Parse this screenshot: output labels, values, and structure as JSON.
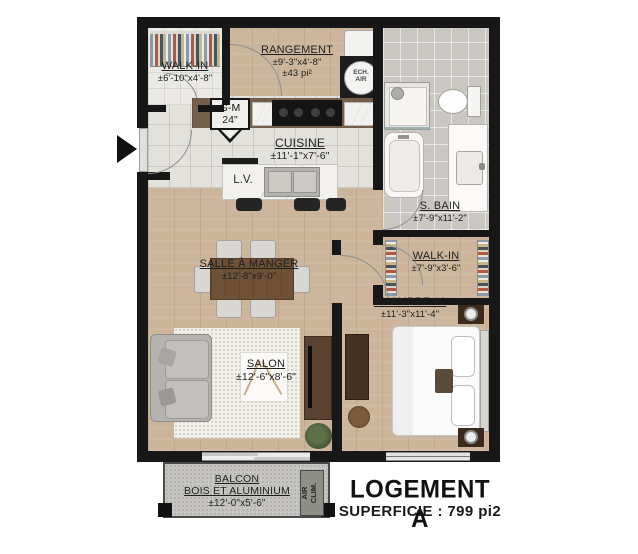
{
  "title_block": {
    "title": "LOGEMENT A",
    "superficie": "SUPERFICIE : 799 pi2"
  },
  "rooms": {
    "walk_in_1": {
      "name": "WALK-IN",
      "dims": "±6'-10\"x4'-8\""
    },
    "rangement": {
      "name": "RANGEMENT",
      "dims": "±9'-3\"x4'-8\"",
      "area": "±43 pi²"
    },
    "garde_manger": {
      "name": "G-M",
      "size": "24\""
    },
    "cuisine": {
      "name": "CUISINE",
      "dims": "±11'-1\"x7'-6\""
    },
    "lave_vaisselle": {
      "label": "L.V."
    },
    "salle_de_bain": {
      "name": "S. BAIN",
      "dims": "±7'-9\"x11'-2\""
    },
    "walk_in_2": {
      "name": "WALK-IN",
      "dims": "±7'-9\"x3'-6\""
    },
    "chambre": {
      "name": "CHAMBRE #1",
      "dims": "±11'-3\"x11'-4\""
    },
    "salle_a_manger": {
      "name": "SALLE À MANGER",
      "dims": "±12'-8\"x9'-0\""
    },
    "salon": {
      "name": "SALON",
      "dims": "±12'-6\"x8'-6\""
    },
    "balcon": {
      "name": "BALCON",
      "material": "BOIS ET ALUMINIUM",
      "dims": "±12'-0\"x5'-6\""
    }
  },
  "equipment": {
    "ech_air": {
      "line1": "ECH.",
      "line2": "AIR"
    },
    "air_clim": {
      "line1": "AIR",
      "line2": "CLIM."
    }
  },
  "colors": {
    "wall": "#171717",
    "wood_floor": "#ccb59b",
    "kitchen_tile": "#e3e1dc",
    "bath_tile": "#cac7c2",
    "concrete": "#c7c5c1"
  }
}
